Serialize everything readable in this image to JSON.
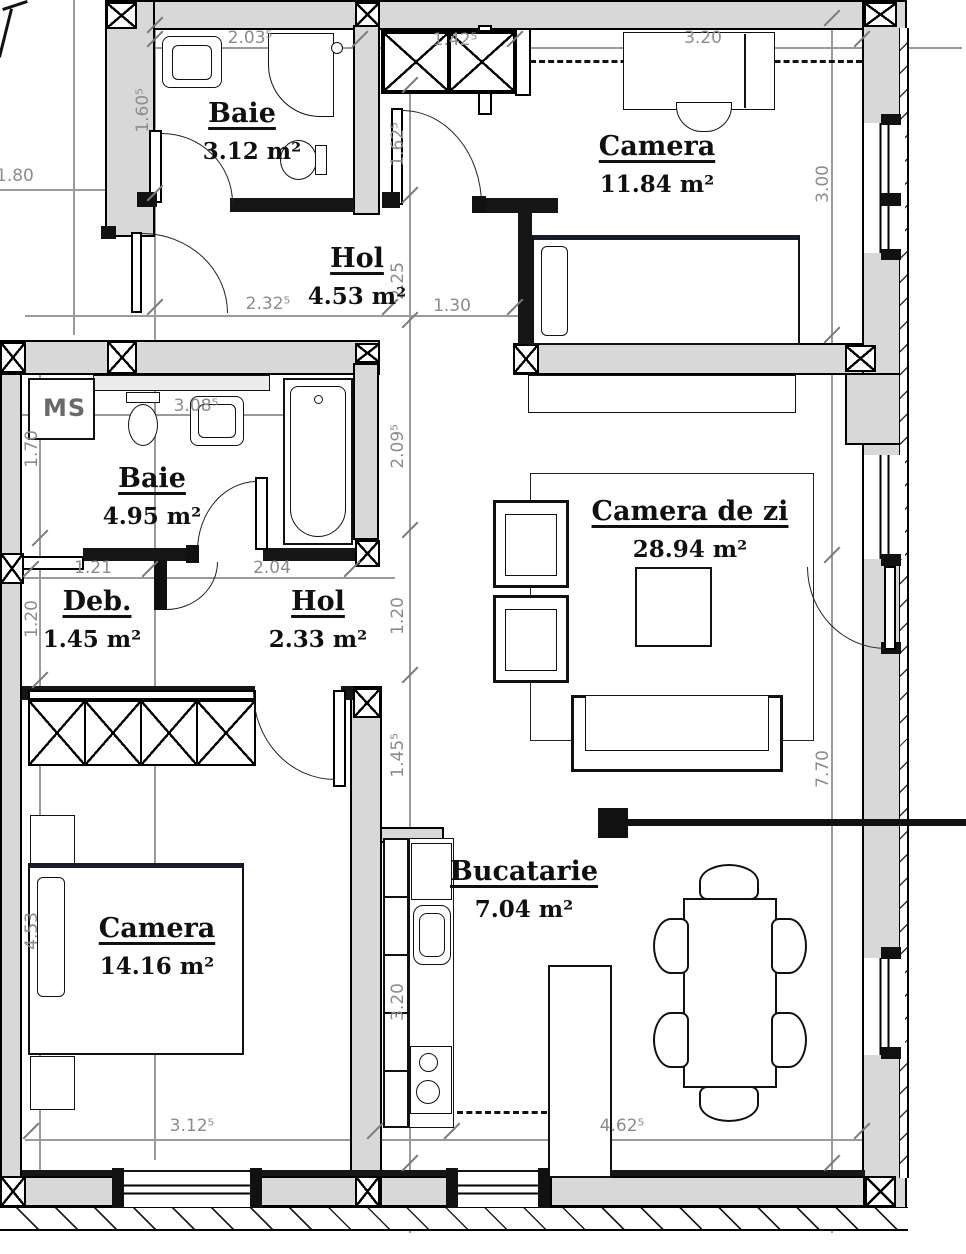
{
  "plan": {
    "rooms": {
      "baie_top": {
        "name": "Baie",
        "area": "3.12 m²"
      },
      "camera_top": {
        "name": "Camera",
        "area": "11.84 m²"
      },
      "hol_top": {
        "name": "Hol",
        "area": "4.53 m²"
      },
      "baie_mid": {
        "name": "Baie",
        "area": "4.95 m²"
      },
      "deb": {
        "name": "Deb.",
        "area": "1.45 m²"
      },
      "hol_mid": {
        "name": "Hol",
        "area": "2.33 m²"
      },
      "living": {
        "name": "Camera de zi",
        "area": "28.94 m²"
      },
      "bedroom": {
        "name": "Camera",
        "area": "14.16 m²"
      },
      "kitchen": {
        "name": "Bucatarie",
        "area": "7.04 m²"
      }
    },
    "labels": {
      "washing_machine": "MS"
    },
    "dims": {
      "t1": "2.03⁵",
      "t2": "1.42⁵",
      "t3": "3.20",
      "l180": "1.80",
      "m1": "2.32⁵",
      "m2": "1.30",
      "m3": "3.08⁵",
      "m4": "1.21",
      "m5": "2.04",
      "b1": "3.12⁵",
      "b2": "4.62⁵",
      "v155": "1.60⁵",
      "v40a": "1.70",
      "v40b": "1.20",
      "v40c": "4.53",
      "c1": "1.62⁵",
      "c2": "2.25",
      "c3": "2.09⁵",
      "c4": "1.20",
      "c5": "1.45⁵",
      "c6": "3.20",
      "r1": "3.00",
      "r2": "7.70"
    },
    "colors": {
      "wall_fill": "#d8d8d8",
      "line": "#000000",
      "dim_text": "#8c8c8c"
    }
  }
}
